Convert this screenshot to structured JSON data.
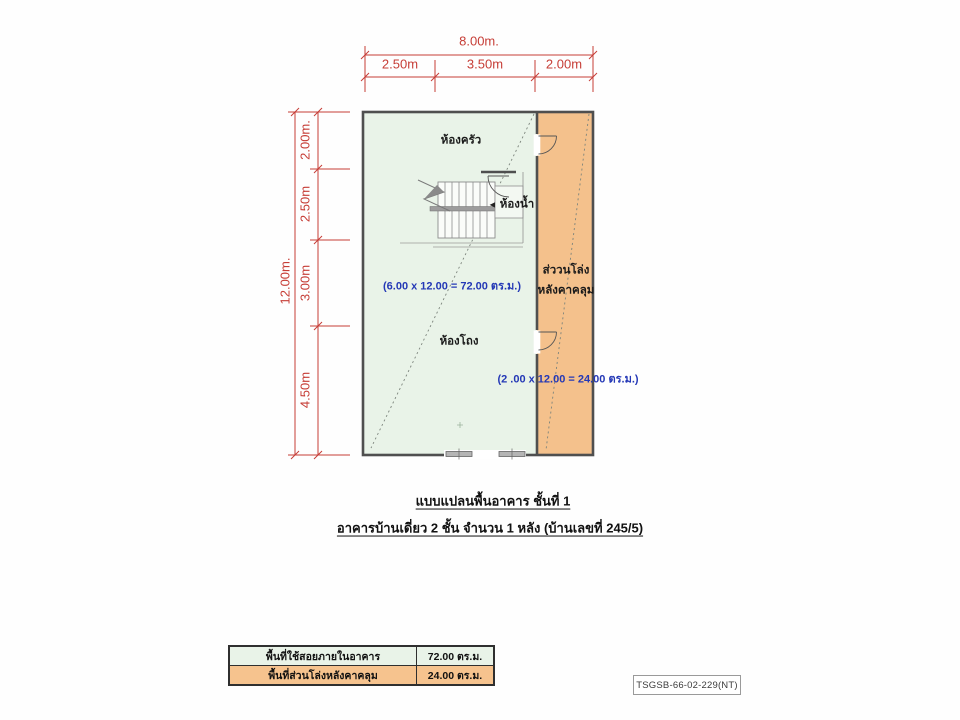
{
  "plan": {
    "dims_top": {
      "overall": "8.00m.",
      "segments": [
        "2.50m",
        "3.50m",
        "2.00m"
      ]
    },
    "dims_left": {
      "overall": "12.00m.",
      "segments": [
        "2.00m.",
        "2.50m",
        "3.00m",
        "4.50m"
      ]
    },
    "rooms": {
      "kitchen": "ห้องครัว",
      "bathroom": "ห้องน้ำ",
      "hall": "ห้องโถง",
      "open_area_line1": "ส่ววนโล่ง",
      "open_area_line2": "หลังคาคลุม"
    },
    "areas": {
      "interior": "(6.00 x 12.00 = 72.00 ตร.ม.)",
      "covered": "(2 .00 x 12.00 = 24.00 ตร.ม.)"
    },
    "colors": {
      "interior_fill": "#e9f3e8",
      "covered_fill": "#f4c18c",
      "dimension_red": "#c63d36",
      "area_text_blue": "#2438b6",
      "wall": "#4f4f4f"
    }
  },
  "icons": {
    "arrow_left": "◄"
  },
  "title": {
    "line1": "แบบแปลนพื้นอาคาร  ชั้นที่ 1",
    "line2": "อาคารบ้านเดี่ยว 2 ชั้น จำนวน 1 หลัง (บ้านเลขที่ 245/5)"
  },
  "legend_table": {
    "rows": [
      {
        "label": "พื้นที่ใช้สอยภายในอาคาร",
        "value": "72.00 ตร.ม."
      },
      {
        "label": "พื้นที่ส่วนโล่งหลังคาคลุม",
        "value": "24.00 ตร.ม."
      }
    ]
  },
  "doc_code": "TSGSB-66-02-229(NT)"
}
